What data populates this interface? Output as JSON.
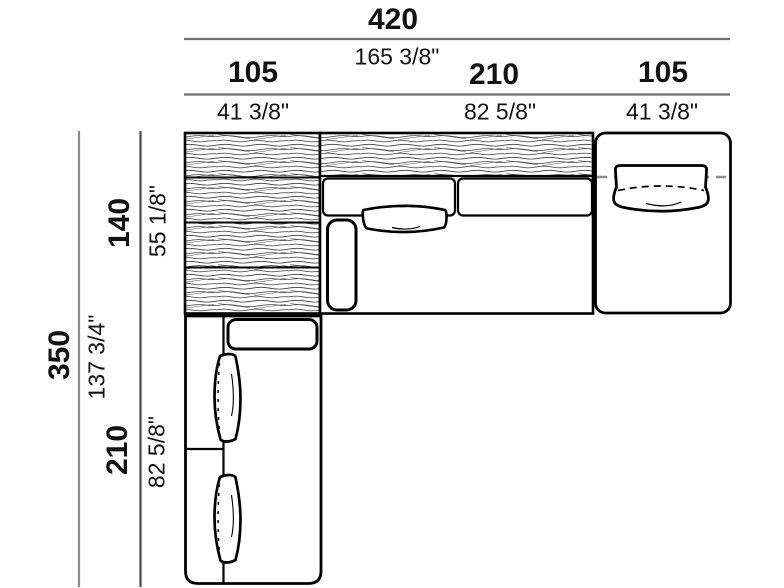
{
  "drawing": {
    "colors": {
      "outline": "#000000",
      "dimension_line_outer": "#8c8c8c",
      "dimension_line_inner": "#4a4a4a",
      "dashed_guide": "#8f8f8f",
      "hatch_line": "#3c3c3c",
      "text": "#121212"
    },
    "dimensions": {
      "top": {
        "total": {
          "cm": "420",
          "inches": "165 3/8\""
        },
        "segments": [
          {
            "cm": "105",
            "inches": "41 3/8\""
          },
          {
            "cm": "210",
            "inches": "82 5/8\""
          },
          {
            "cm": "105",
            "inches": "41 3/8\""
          }
        ]
      },
      "left": {
        "total": {
          "cm": "350",
          "inches": "137 3/4\""
        },
        "segments": [
          {
            "cm": "140",
            "inches": "55 1/8\""
          },
          {
            "cm": "210",
            "inches": "82 5/8\""
          }
        ]
      }
    }
  }
}
